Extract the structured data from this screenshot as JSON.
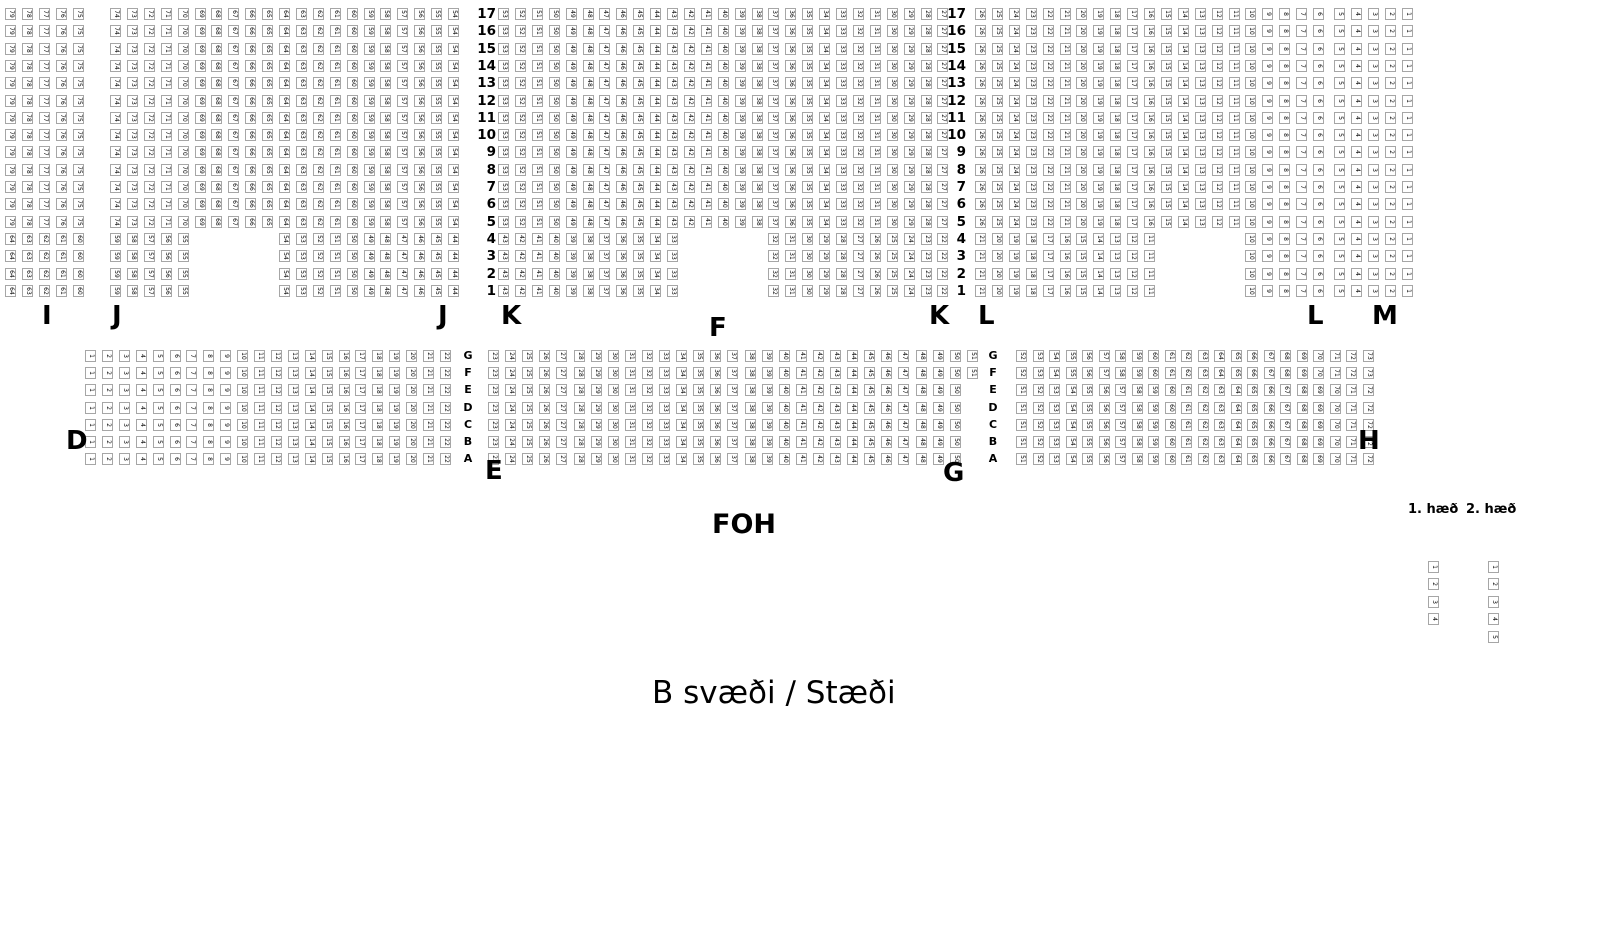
{
  "title": {
    "text": "B svæði / Stæði",
    "x": 652,
    "y": 678
  },
  "foh": {
    "label": "FOH",
    "x": 712,
    "y": 511
  },
  "colors": {
    "seat_border": "#a6a6a6",
    "seat_fill": "#ffffff",
    "seat_text": "#000000",
    "label_text": "#000000"
  },
  "seat_box": {
    "w": 11,
    "h": 12
  },
  "top_band": {
    "y0": 8,
    "row_pitch": 17.3,
    "rows_from": 17,
    "rows_to": 1,
    "short_rows_max": 4,
    "row_number_columns_x_right": [
      496,
      966
    ],
    "numbering": "seat 1 at far right, numbers ascend right-to-left",
    "sections": [
      {
        "label": "I",
        "x0": 5,
        "pitch": 16.9,
        "cols": 5,
        "full_groups": [
          {
            "col": 0,
            "start": 79,
            "count": 5
          }
        ],
        "short_groups": [
          {
            "col": 0,
            "start": 64,
            "count": 5
          }
        ]
      },
      {
        "label": "J",
        "x0": 110,
        "pitch": 16.9,
        "cols": 21,
        "full_groups": [
          {
            "col": 0,
            "start": 74,
            "count": 21
          }
        ],
        "short_groups": [
          {
            "col": 0,
            "start": 59,
            "count": 5
          },
          {
            "col": 10,
            "start": 54,
            "count": 11
          }
        ]
      },
      {
        "label": "K",
        "x0": 498,
        "pitch": 16.9,
        "cols": 27,
        "full_groups": [
          {
            "col": 0,
            "start": 53,
            "count": 27
          }
        ],
        "short_groups": [
          {
            "col": 0,
            "start": 43,
            "count": 11
          },
          {
            "col": 16,
            "start": 32,
            "count": 11
          }
        ]
      },
      {
        "label": "L",
        "x0": 975,
        "pitch": 16.9,
        "cols": 21,
        "full_groups": [
          {
            "col": 0,
            "start": 26,
            "count": 21
          }
        ],
        "short_groups": [
          {
            "col": 0,
            "start": 21,
            "count": 11
          },
          {
            "col": 16,
            "start": 10,
            "count": 5
          }
        ]
      },
      {
        "label": "M",
        "x0": 1334,
        "pitch": 16.9,
        "cols": 5,
        "full_groups": [
          {
            "col": 0,
            "start": 5,
            "count": 5
          }
        ],
        "short_groups": [
          {
            "col": 0,
            "start": 5,
            "count": 5
          }
        ]
      }
    ]
  },
  "middle_band": {
    "y0": 350,
    "row_pitch": 17.2,
    "row_letters": [
      "G",
      "F",
      "E",
      "D",
      "C",
      "B",
      "A"
    ],
    "letter_columns_x": [
      468,
      993
    ],
    "numbering": "numbers ascend left-to-right, continuous across the three blocks",
    "blocks": [
      {
        "x0": 85,
        "pitch": 16.9,
        "rows_gf": {
          "start": 1,
          "count": 22
        },
        "rows_ea": {
          "start": 1,
          "count": 22
        }
      },
      {
        "x0": 488,
        "pitch": 17.1,
        "rows_gf": {
          "start": 23,
          "count": 29
        },
        "rows_ea": {
          "start": 23,
          "count": 28
        }
      },
      {
        "x0": 1016,
        "pitch": 16.5,
        "rows_gf": {
          "start": 52,
          "count": 22
        },
        "rows_ea": {
          "start": 51,
          "count": 22
        }
      }
    ]
  },
  "section_labels": [
    {
      "text": "I",
      "x": 42,
      "y": 303
    },
    {
      "text": "J",
      "x": 112,
      "y": 303
    },
    {
      "text": "J",
      "x": 438,
      "y": 303
    },
    {
      "text": "K",
      "x": 501,
      "y": 303
    },
    {
      "text": "K",
      "x": 929,
      "y": 303
    },
    {
      "text": "L",
      "x": 978,
      "y": 303
    },
    {
      "text": "L",
      "x": 1307,
      "y": 303
    },
    {
      "text": "M",
      "x": 1372,
      "y": 303
    },
    {
      "text": "F",
      "x": 709,
      "y": 315
    },
    {
      "text": "D",
      "x": 66,
      "y": 428
    },
    {
      "text": "E",
      "x": 485,
      "y": 458
    },
    {
      "text": "G",
      "x": 943,
      "y": 460
    },
    {
      "text": "H",
      "x": 1358,
      "y": 428
    }
  ],
  "legend": {
    "label_y": 503,
    "seats_y0": 561,
    "pitch": 17.4,
    "columns": [
      {
        "label": "1. hæð",
        "label_x": 1408,
        "x": 1428,
        "seats": [
          1,
          2,
          3,
          4
        ]
      },
      {
        "label": "2. hæð",
        "label_x": 1466,
        "x": 1488,
        "seats": [
          1,
          2,
          3,
          4,
          5
        ]
      }
    ]
  }
}
